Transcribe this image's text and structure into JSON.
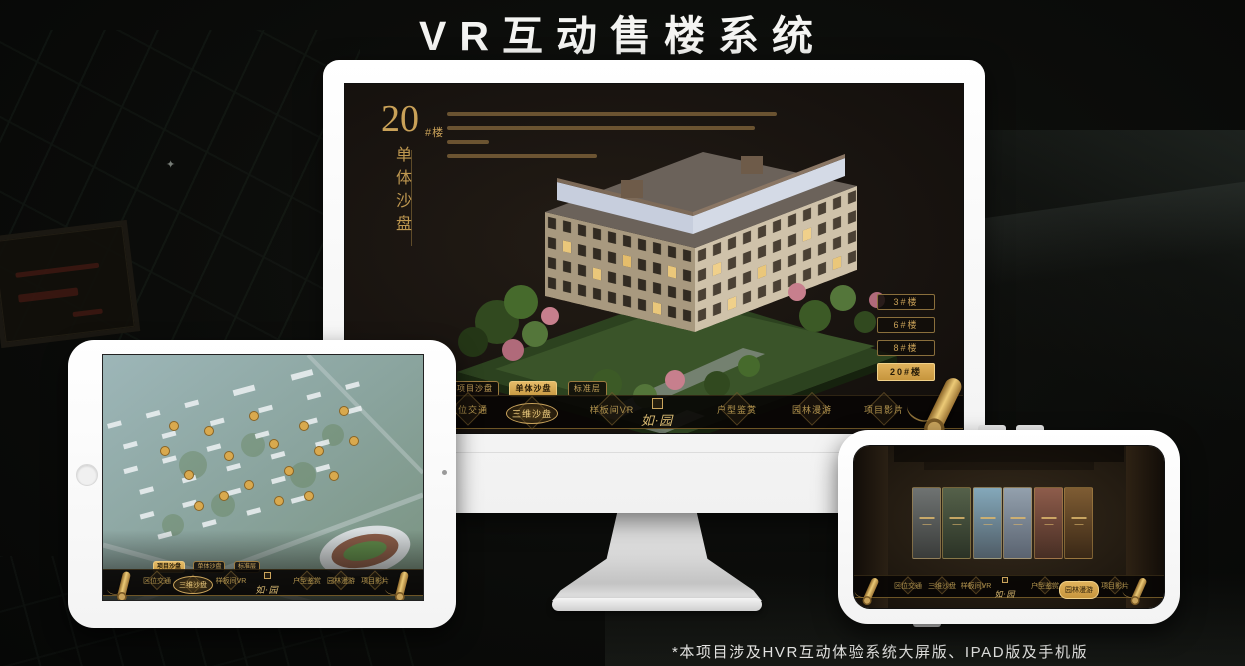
{
  "page": {
    "title": "VR互动售楼系统",
    "footnote": "*本项目涉及HVR互动体验系统大屏版、IPAD版及手机版"
  },
  "colors": {
    "gold": "#c9a158",
    "gold_bright": "#ecca7e",
    "active_button_bg": "#d8ab5e",
    "screen_bg": "#191410",
    "device_frame": "#ffffff"
  },
  "desktop_app": {
    "heading": {
      "number": "20",
      "suffix": "#楼",
      "subtitle": "单体沙盘"
    },
    "floor_buttons": [
      {
        "label": "3#楼",
        "active": false
      },
      {
        "label": "6#楼",
        "active": false
      },
      {
        "label": "8#楼",
        "active": false
      },
      {
        "label": "20#楼",
        "active": true
      }
    ],
    "mode_buttons": [
      {
        "label": "项目沙盘",
        "active": false
      },
      {
        "label": "单体沙盘",
        "active": true
      },
      {
        "label": "标准层",
        "active": false
      }
    ],
    "nav": {
      "logo": "如·园",
      "items": [
        {
          "label": "区位交通",
          "active": false
        },
        {
          "label": "三维沙盘",
          "active": true
        },
        {
          "label": "样板间VR",
          "active": false
        },
        {
          "label": "户型鉴赏",
          "active": false
        },
        {
          "label": "园林漫游",
          "active": false
        },
        {
          "label": "项目影片",
          "active": false
        }
      ]
    }
  },
  "tablet_app": {
    "mode_buttons": [
      {
        "label": "项目沙盘",
        "active": true
      },
      {
        "label": "单体沙盘",
        "active": false
      },
      {
        "label": "标准层",
        "active": false
      }
    ],
    "nav": {
      "logo": "如·园",
      "items": [
        {
          "label": "区位交通",
          "active": false
        },
        {
          "label": "三维沙盘",
          "active": true
        },
        {
          "label": "样板间VR",
          "active": false
        },
        {
          "label": "户型鉴赏",
          "active": false
        },
        {
          "label": "园林漫游",
          "active": false
        },
        {
          "label": "项目影片",
          "active": false
        }
      ]
    }
  },
  "phone_app": {
    "nav": {
      "logo": "如·园",
      "items": [
        {
          "label": "区位交通",
          "active": false
        },
        {
          "label": "三维沙盘",
          "active": false
        },
        {
          "label": "样板间VR",
          "active": false
        },
        {
          "label": "户型鉴赏",
          "active": false
        },
        {
          "label": "园林漫游",
          "active": true
        },
        {
          "label": "项目影片",
          "active": false
        }
      ]
    }
  }
}
